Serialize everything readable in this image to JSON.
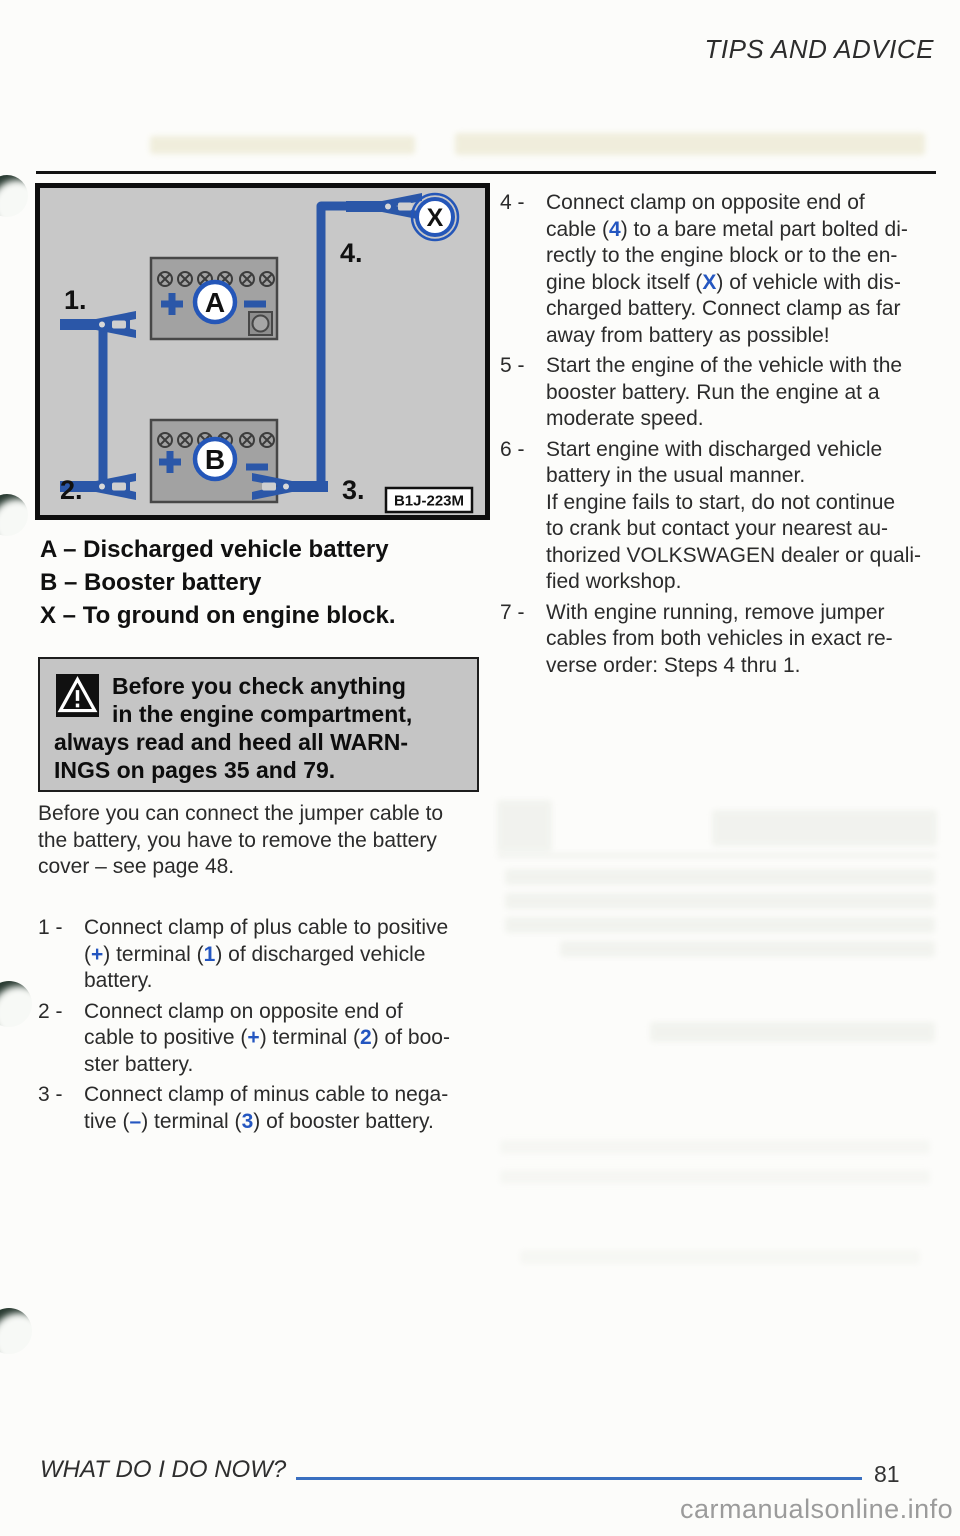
{
  "header": {
    "title": "TIPS AND ADVICE"
  },
  "figure": {
    "code": "B1J-223M",
    "callouts": {
      "n1": "1.",
      "n2": "2.",
      "n3": "3.",
      "n4": "4.",
      "battery_a": "A",
      "battery_b": "B",
      "ground_x": "X"
    },
    "colors": {
      "cable_blue": "#2b57a8",
      "callout_ring_blue": "#2456b8",
      "panel_gray": "#c8c8c8",
      "battery_gray": "#a2a2a2"
    }
  },
  "legend": {
    "items": [
      "A – Discharged vehicle battery",
      "B – Booster battery",
      "X – To ground on engine block."
    ]
  },
  "warning": {
    "lines": [
      "Before you check anything",
      "in the engine compartment,",
      "always read and heed all WARN-",
      "INGS on pages 35 and 79."
    ]
  },
  "intro": {
    "lines": [
      "Before you can connect the jumper cable to",
      "the battery, you have to remove the battery",
      "cover – see page 48."
    ]
  },
  "steps": [
    {
      "num": "1 -",
      "lines": [
        [
          {
            "t": "Connect clamp of plus cable to positive"
          }
        ],
        [
          {
            "t": "("
          },
          {
            "t": "+",
            "b": true
          },
          {
            "t": ") terminal ("
          },
          {
            "t": "1",
            "b": true
          },
          {
            "t": ") of discharged vehicle"
          }
        ],
        [
          {
            "t": "battery."
          }
        ]
      ]
    },
    {
      "num": "2 -",
      "lines": [
        [
          {
            "t": "Connect clamp on opposite end of"
          }
        ],
        [
          {
            "t": "cable to positive ("
          },
          {
            "t": "+",
            "b": true
          },
          {
            "t": ") terminal ("
          },
          {
            "t": "2",
            "b": true
          },
          {
            "t": ") of boo-"
          }
        ],
        [
          {
            "t": "ster battery."
          }
        ]
      ]
    },
    {
      "num": "3 -",
      "lines": [
        [
          {
            "t": "Connect clamp of minus cable to nega-"
          }
        ],
        [
          {
            "t": "tive ("
          },
          {
            "t": "–",
            "b": true
          },
          {
            "t": ") terminal ("
          },
          {
            "t": "3",
            "b": true
          },
          {
            "t": ") of booster battery."
          }
        ]
      ]
    },
    {
      "num": "4 -",
      "lines": [
        [
          {
            "t": "Connect clamp on opposite end of"
          }
        ],
        [
          {
            "t": "cable ("
          },
          {
            "t": "4",
            "b": true
          },
          {
            "t": ") to a bare metal part bolted di-"
          }
        ],
        [
          {
            "t": "rectly to the engine block or to the en-"
          }
        ],
        [
          {
            "t": "gine block itself ("
          },
          {
            "t": "X",
            "b": true
          },
          {
            "t": ") of vehicle with dis-"
          }
        ],
        [
          {
            "t": "charged battery.  Connect clamp as far"
          }
        ],
        [
          {
            "t": "away from battery as possible!"
          }
        ]
      ]
    },
    {
      "num": "5 -",
      "lines": [
        "Start the engine of the vehicle with the",
        "booster battery.  Run the engine at a",
        "moderate speed."
      ]
    },
    {
      "num": "6 -",
      "lines": [
        "Start engine with discharged vehicle",
        "battery in the usual manner.",
        "If engine fails to start, do not continue",
        "to crank but contact your nearest au-",
        "thorized VOLKSWAGEN dealer or quali-",
        "fied workshop."
      ]
    },
    {
      "num": "7 -",
      "lines": [
        "With engine running, remove jumper",
        "cables from both vehicles in exact re-",
        "verse order: Steps 4 thru 1."
      ]
    }
  ],
  "footer": {
    "section": "WHAT DO I DO NOW?",
    "page_number": "81",
    "watermark": "carmanualsonline.info"
  },
  "colors": {
    "accent_blue": "#2456c0",
    "footer_rule_blue": "#3a6fc0"
  }
}
